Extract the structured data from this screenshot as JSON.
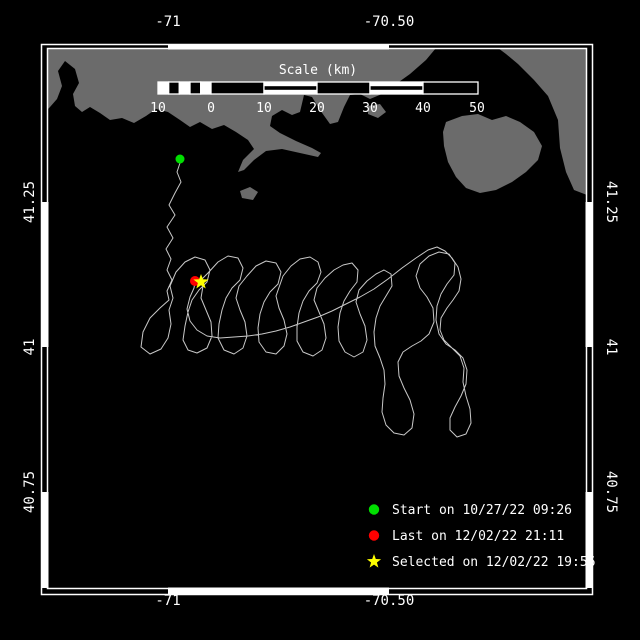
{
  "window": {
    "width": 640,
    "height": 640,
    "background": "#000000"
  },
  "map": {
    "colors": {
      "background": "#000000",
      "land": "#6b6b6b",
      "track": "#c8c8c8",
      "frame": "#ffffff",
      "text": "#ffffff",
      "start_marker": "#00df00",
      "last_marker": "#ff0000",
      "selected_marker": "#ffff00"
    },
    "frame": {
      "outer": [
        41.5,
        44.5,
        592.5,
        594.5
      ],
      "inner": [
        47.5,
        48.5,
        586.5,
        588.5
      ],
      "band_white_x": [
        [
          168,
          389
        ]
      ],
      "band_white_y": [
        [
          202,
          347
        ],
        [
          492,
          588
        ]
      ]
    },
    "axis": {
      "top": [
        {
          "x": 168,
          "label": "-71"
        },
        {
          "x": 389,
          "label": "-70.50"
        }
      ],
      "bottom": [
        {
          "x": 168,
          "label": "-71"
        },
        {
          "x": 389,
          "label": "-70.50"
        }
      ],
      "left": [
        {
          "y": 202,
          "label": "41.25"
        },
        {
          "y": 347,
          "label": "41"
        },
        {
          "y": 492,
          "label": "40.75"
        }
      ],
      "right": [
        {
          "y": 202,
          "label": "41.25"
        },
        {
          "y": 347,
          "label": "41"
        },
        {
          "y": 492,
          "label": "40.75"
        }
      ],
      "top_label_y": 26,
      "bottom_label_y": 605,
      "left_label_x": 34,
      "right_label_x": 607
    },
    "scalebar": {
      "title": "Scale (km)",
      "title_x": 318,
      "title_y": 74,
      "y0": 82,
      "y1": 94,
      "cells": [
        {
          "x0": 158.0,
          "x1": 168.7,
          "type": "white"
        },
        {
          "x0": 168.7,
          "x1": 179.3,
          "type": "black"
        },
        {
          "x0": 179.3,
          "x1": 190.0,
          "type": "white"
        },
        {
          "x0": 190.0,
          "x1": 200.7,
          "type": "black"
        },
        {
          "x0": 200.7,
          "x1": 211.0,
          "type": "white"
        },
        {
          "x0": 211.0,
          "x1": 264.0,
          "type": "black"
        },
        {
          "x0": 264.0,
          "x1": 317.0,
          "type": "striped"
        },
        {
          "x0": 317.0,
          "x1": 370.0,
          "type": "black"
        },
        {
          "x0": 370.0,
          "x1": 423.0,
          "type": "striped"
        },
        {
          "x0": 423.0,
          "x1": 478.0,
          "type": "black"
        }
      ],
      "ticks": [
        {
          "x": 158,
          "label": "10"
        },
        {
          "x": 211,
          "label": "0"
        },
        {
          "x": 264,
          "label": "10"
        },
        {
          "x": 317,
          "label": "20"
        },
        {
          "x": 370,
          "label": "30"
        },
        {
          "x": 423,
          "label": "40"
        },
        {
          "x": 477,
          "label": "50"
        }
      ],
      "tick_label_y": 112
    },
    "legend": {
      "marker_x": 374,
      "text_x": 392,
      "row0_y": 509.5,
      "row_dy": 26,
      "items": [
        {
          "marker": "circle",
          "color": "#00df00",
          "label": "Start on 10/27/22 09:26"
        },
        {
          "marker": "circle",
          "color": "#ff0000",
          "label": "Last on 12/02/22 21:11"
        },
        {
          "marker": "star",
          "color": "#ffff00",
          "label": "Selected on 12/02/22 19:56"
        }
      ]
    },
    "markers": {
      "start": {
        "x": 180,
        "y": 159,
        "shape": "circle",
        "color": "#00df00"
      },
      "last": {
        "x": 195,
        "y": 281,
        "shape": "circle",
        "color": "#ff0000"
      },
      "selected": {
        "x": 201,
        "y": 282,
        "shape": "star",
        "color": "#ffff00"
      }
    },
    "land": [
      [
        [
          47,
          48
        ],
        [
          436,
          48
        ],
        [
          426,
          60
        ],
        [
          410,
          74
        ],
        [
          396,
          84
        ],
        [
          382,
          94
        ],
        [
          370,
          99
        ],
        [
          360,
          94
        ],
        [
          350,
          95
        ],
        [
          344,
          107
        ],
        [
          338,
          122
        ],
        [
          330,
          124
        ],
        [
          320,
          110
        ],
        [
          312,
          97
        ],
        [
          304,
          95
        ],
        [
          300,
          112
        ],
        [
          292,
          115
        ],
        [
          282,
          110
        ],
        [
          272,
          116
        ],
        [
          270,
          126
        ],
        [
          280,
          133
        ],
        [
          296,
          141
        ],
        [
          312,
          148
        ],
        [
          321,
          153
        ],
        [
          318,
          157
        ],
        [
          300,
          153
        ],
        [
          282,
          149
        ],
        [
          266,
          151
        ],
        [
          254,
          160
        ],
        [
          244,
          170
        ],
        [
          238,
          172
        ],
        [
          243,
          160
        ],
        [
          254,
          149
        ],
        [
          248,
          140
        ],
        [
          236,
          132
        ],
        [
          224,
          125
        ],
        [
          212,
          129
        ],
        [
          200,
          122
        ],
        [
          190,
          127
        ],
        [
          180,
          120
        ],
        [
          168,
          112
        ],
        [
          156,
          109
        ],
        [
          146,
          116
        ],
        [
          134,
          123
        ],
        [
          122,
          118
        ],
        [
          110,
          120
        ],
        [
          100,
          113
        ],
        [
          90,
          107
        ],
        [
          82,
          112
        ],
        [
          75,
          106
        ],
        [
          73,
          94
        ],
        [
          79,
          83
        ],
        [
          75,
          69
        ],
        [
          65,
          61
        ],
        [
          58,
          71
        ],
        [
          62,
          86
        ],
        [
          57,
          99
        ],
        [
          50,
          107
        ],
        [
          47,
          110
        ]
      ],
      [
        [
          446,
          122
        ],
        [
          462,
          116
        ],
        [
          478,
          114
        ],
        [
          492,
          120
        ],
        [
          506,
          116
        ],
        [
          520,
          122
        ],
        [
          534,
          132
        ],
        [
          542,
          146
        ],
        [
          538,
          160
        ],
        [
          526,
          172
        ],
        [
          512,
          182
        ],
        [
          496,
          190
        ],
        [
          480,
          193
        ],
        [
          466,
          188
        ],
        [
          456,
          177
        ],
        [
          448,
          162
        ],
        [
          444,
          146
        ],
        [
          443,
          132
        ]
      ],
      [
        [
          498,
          48
        ],
        [
          587,
          48
        ],
        [
          587,
          195
        ],
        [
          574,
          190
        ],
        [
          566,
          172
        ],
        [
          560,
          148
        ],
        [
          558,
          120
        ],
        [
          548,
          96
        ],
        [
          534,
          80
        ],
        [
          518,
          64
        ],
        [
          506,
          54
        ]
      ],
      [
        [
          240,
          191
        ],
        [
          250,
          187
        ],
        [
          258,
          192
        ],
        [
          253,
          200
        ],
        [
          242,
          198
        ]
      ],
      [
        [
          368,
          106
        ],
        [
          380,
          104
        ],
        [
          386,
          112
        ],
        [
          378,
          118
        ],
        [
          368,
          114
        ]
      ]
    ],
    "track": [
      [
        180,
        163
      ],
      [
        177,
        172
      ],
      [
        181,
        182
      ],
      [
        175,
        193
      ],
      [
        169,
        205
      ],
      [
        175,
        215
      ],
      [
        167,
        227
      ],
      [
        173,
        238
      ],
      [
        166,
        249
      ],
      [
        171,
        259
      ],
      [
        167,
        270
      ],
      [
        172,
        280
      ],
      [
        167,
        291
      ],
      [
        169,
        300
      ],
      [
        160,
        308
      ],
      [
        150,
        318
      ],
      [
        143,
        332
      ],
      [
        141,
        347
      ],
      [
        150,
        354
      ],
      [
        161,
        349
      ],
      [
        168,
        338
      ],
      [
        171,
        324
      ],
      [
        169,
        310
      ],
      [
        173,
        298
      ],
      [
        170,
        286
      ],
      [
        176,
        272
      ],
      [
        185,
        262
      ],
      [
        195,
        257
      ],
      [
        205,
        260
      ],
      [
        210,
        270
      ],
      [
        207,
        282
      ],
      [
        199,
        290
      ],
      [
        192,
        300
      ],
      [
        188,
        312
      ],
      [
        185,
        326
      ],
      [
        183,
        340
      ],
      [
        188,
        350
      ],
      [
        197,
        353
      ],
      [
        207,
        348
      ],
      [
        212,
        336
      ],
      [
        211,
        322
      ],
      [
        206,
        310
      ],
      [
        201,
        298
      ],
      [
        203,
        286
      ],
      [
        200,
        281
      ],
      [
        208,
        273
      ],
      [
        218,
        262
      ],
      [
        228,
        256
      ],
      [
        238,
        258
      ],
      [
        243,
        268
      ],
      [
        240,
        280
      ],
      [
        232,
        288
      ],
      [
        226,
        298
      ],
      [
        222,
        310
      ],
      [
        219,
        324
      ],
      [
        218,
        338
      ],
      [
        224,
        350
      ],
      [
        234,
        354
      ],
      [
        243,
        348
      ],
      [
        247,
        336
      ],
      [
        245,
        322
      ],
      [
        240,
        310
      ],
      [
        236,
        298
      ],
      [
        239,
        286
      ],
      [
        247,
        276
      ],
      [
        256,
        266
      ],
      [
        266,
        261
      ],
      [
        276,
        263
      ],
      [
        281,
        272
      ],
      [
        278,
        284
      ],
      [
        270,
        292
      ],
      [
        264,
        302
      ],
      [
        260,
        314
      ],
      [
        258,
        328
      ],
      [
        259,
        342
      ],
      [
        266,
        352
      ],
      [
        276,
        354
      ],
      [
        284,
        346
      ],
      [
        287,
        334
      ],
      [
        284,
        320
      ],
      [
        279,
        308
      ],
      [
        276,
        296
      ],
      [
        283,
        276
      ],
      [
        291,
        266
      ],
      [
        300,
        259
      ],
      [
        310,
        257
      ],
      [
        318,
        262
      ],
      [
        321,
        272
      ],
      [
        317,
        283
      ],
      [
        309,
        291
      ],
      [
        303,
        301
      ],
      [
        299,
        313
      ],
      [
        297,
        327
      ],
      [
        297,
        341
      ],
      [
        303,
        352
      ],
      [
        313,
        356
      ],
      [
        322,
        350
      ],
      [
        326,
        338
      ],
      [
        324,
        324
      ],
      [
        319,
        312
      ],
      [
        314,
        300
      ],
      [
        317,
        288
      ],
      [
        325,
        278
      ],
      [
        334,
        270
      ],
      [
        343,
        265
      ],
      [
        352,
        263
      ],
      [
        358,
        270
      ],
      [
        357,
        282
      ],
      [
        350,
        291
      ],
      [
        344,
        301
      ],
      [
        340,
        313
      ],
      [
        338,
        327
      ],
      [
        339,
        341
      ],
      [
        345,
        352
      ],
      [
        354,
        357
      ],
      [
        363,
        352
      ],
      [
        367,
        340
      ],
      [
        365,
        326
      ],
      [
        360,
        314
      ],
      [
        356,
        302
      ],
      [
        359,
        290
      ],
      [
        367,
        281
      ],
      [
        376,
        274
      ],
      [
        384,
        270
      ],
      [
        391,
        274
      ],
      [
        392,
        286
      ],
      [
        386,
        296
      ],
      [
        380,
        306
      ],
      [
        376,
        318
      ],
      [
        374,
        332
      ],
      [
        375,
        346
      ],
      [
        380,
        358
      ],
      [
        384,
        370
      ],
      [
        385,
        384
      ],
      [
        383,
        398
      ],
      [
        382,
        412
      ],
      [
        386,
        425
      ],
      [
        394,
        433
      ],
      [
        404,
        435
      ],
      [
        412,
        428
      ],
      [
        414,
        414
      ],
      [
        410,
        400
      ],
      [
        404,
        388
      ],
      [
        399,
        376
      ],
      [
        398,
        362
      ],
      [
        403,
        352
      ],
      [
        412,
        346
      ],
      [
        421,
        341
      ],
      [
        429,
        334
      ],
      [
        434,
        322
      ],
      [
        433,
        308
      ],
      [
        427,
        297
      ],
      [
        420,
        288
      ],
      [
        416,
        276
      ],
      [
        420,
        264
      ],
      [
        429,
        256
      ],
      [
        439,
        252
      ],
      [
        449,
        254
      ],
      [
        455,
        263
      ],
      [
        454,
        275
      ],
      [
        447,
        284
      ],
      [
        441,
        294
      ],
      [
        437,
        306
      ],
      [
        436,
        320
      ],
      [
        439,
        334
      ],
      [
        446,
        344
      ],
      [
        455,
        350
      ],
      [
        463,
        358
      ],
      [
        467,
        370
      ],
      [
        466,
        384
      ],
      [
        461,
        396
      ],
      [
        455,
        407
      ],
      [
        450,
        418
      ],
      [
        450,
        430
      ],
      [
        457,
        437
      ],
      [
        466,
        434
      ],
      [
        471,
        423
      ],
      [
        470,
        409
      ],
      [
        466,
        396
      ],
      [
        463,
        382
      ],
      [
        464,
        368
      ],
      [
        460,
        356
      ],
      [
        452,
        348
      ],
      [
        444,
        340
      ],
      [
        440,
        330
      ],
      [
        441,
        318
      ],
      [
        447,
        308
      ],
      [
        453,
        300
      ],
      [
        459,
        291
      ],
      [
        461,
        279
      ],
      [
        458,
        267
      ],
      [
        452,
        258
      ],
      [
        445,
        251
      ],
      [
        437,
        247
      ],
      [
        428,
        250
      ],
      [
        416,
        258
      ],
      [
        402,
        268
      ],
      [
        388,
        279
      ],
      [
        374,
        289
      ],
      [
        360,
        297
      ],
      [
        346,
        304
      ],
      [
        332,
        311
      ],
      [
        318,
        317
      ],
      [
        304,
        322
      ],
      [
        290,
        327
      ],
      [
        276,
        331
      ],
      [
        262,
        334
      ],
      [
        248,
        336
      ],
      [
        234,
        337
      ],
      [
        220,
        338
      ],
      [
        207,
        336
      ],
      [
        197,
        330
      ],
      [
        190,
        321
      ],
      [
        187,
        309
      ],
      [
        190,
        297
      ],
      [
        194,
        288
      ],
      [
        195,
        282
      ]
    ]
  }
}
